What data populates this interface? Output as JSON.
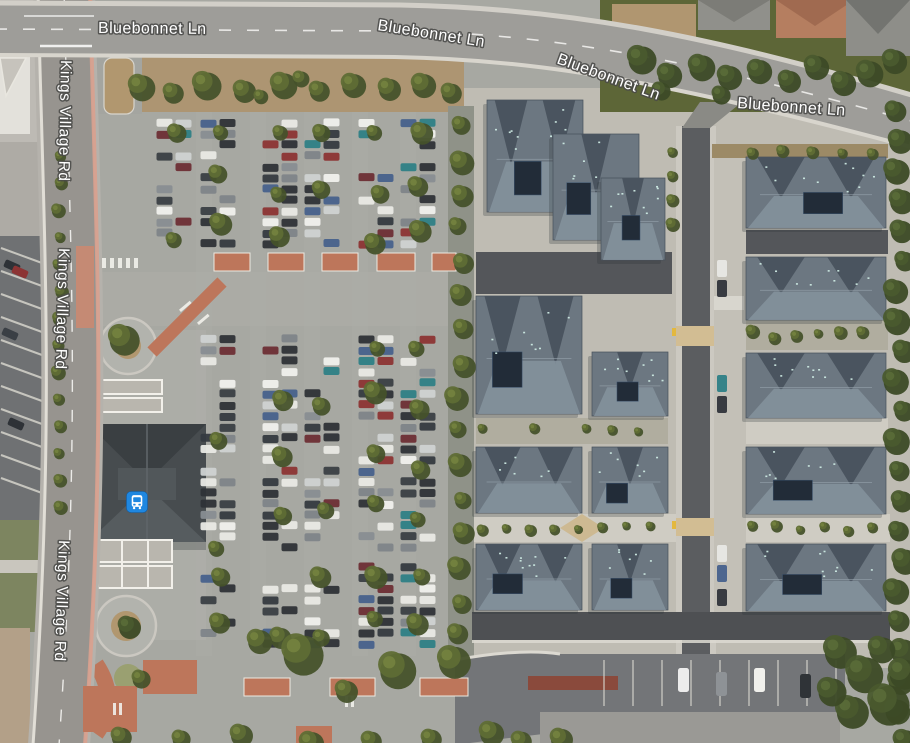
{
  "view": {
    "type": "satellite-map",
    "width": 910,
    "height": 743
  },
  "map": {
    "streets": [
      {
        "name": "Bluebonnet Ln"
      },
      {
        "name": "Kings Village Rd"
      }
    ],
    "road_labels": [
      {
        "street": "Bluebonnet Ln",
        "text": "Bluebonnet Ln"
      },
      {
        "street": "Bluebonnet Ln",
        "text": "Bluebonnet Ln"
      },
      {
        "street": "Bluebonnet Ln",
        "text": "Bluebonnet Ln"
      },
      {
        "street": "Bluebonnet Ln",
        "text": "Bluebonnet Ln"
      },
      {
        "street": "Kings Village Rd",
        "text": "Kings Village Rd"
      },
      {
        "street": "Kings Village Rd",
        "text": "Kings Village Rd"
      },
      {
        "street": "Kings Village Rd",
        "text": "Kings Village Rd"
      }
    ],
    "transit_stop": {
      "kind": "bus-station",
      "icon": "bus-icon"
    }
  },
  "colors": {
    "label_text": "#ffffff",
    "label_halo": "#4a4a48",
    "transit_blue": "#1f87e0"
  }
}
